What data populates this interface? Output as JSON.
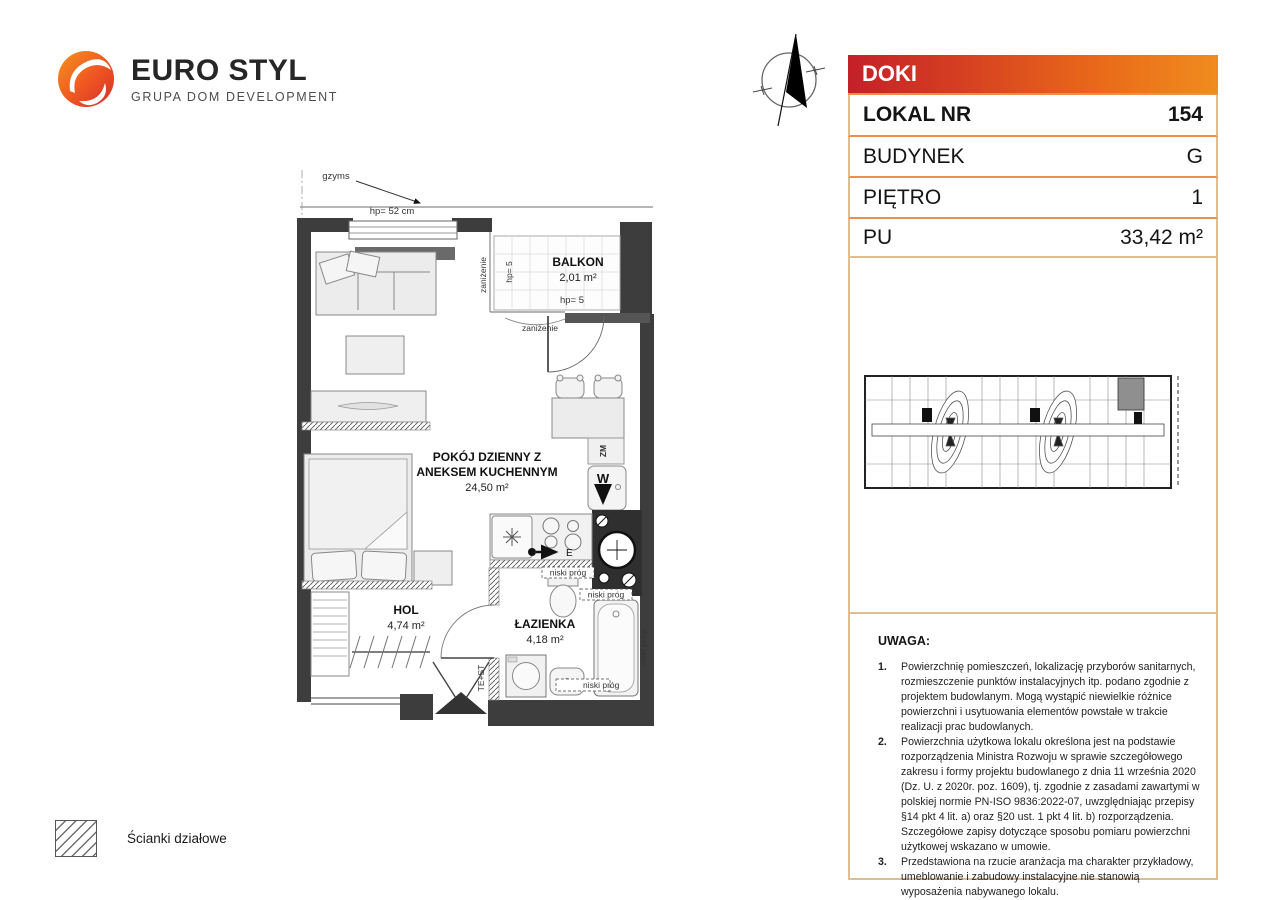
{
  "brand": {
    "name": "EURO STYL",
    "subtitle": "GRUPA DOM DEVELOPMENT"
  },
  "unit_card": {
    "project": "DOKI",
    "rows": [
      {
        "label": "LOKAL NR",
        "value": "154"
      },
      {
        "label": "BUDYNEK",
        "value": "G"
      },
      {
        "label": "PIĘTRO",
        "value": "1"
      },
      {
        "label": "PU",
        "value": "33,42 m²"
      }
    ]
  },
  "floorplan": {
    "labels": {
      "pokoj_line1": "POKÓJ DZIENNY Z",
      "pokoj_line2": "ANEKSEM KUCHENNYM",
      "pokoj_area": "24,50 m²",
      "hol": "HOL",
      "hol_area": "4,74 m²",
      "lazienka": "ŁAZIENKA",
      "lazienka_area": "4,18 m²",
      "balkon": "BALKON",
      "balkon_area": "2,01 m²",
      "gzyms": "gzyms",
      "hp_52": "hp= 52 cm",
      "hp_5": "hp= 5",
      "zanizenie": "zaniżenie",
      "niski_prog": "niski próg",
      "te_st": "TE+ST",
      "zm": "ZM",
      "w": "W",
      "e": "E"
    }
  },
  "notes": {
    "title": "UWAGA:",
    "items": [
      {
        "num": "1.",
        "text": "Powierzchnię pomieszczeń, lokalizację przyborów sanitarnych, rozmieszczenie punktów instalacyjnych itp. podano zgodnie z projektem budowlanym. Mogą wystąpić niewielkie różnice powierzchni i usytuowania elementów powstałe w trakcie realizacji prac budowlanych."
      },
      {
        "num": "2.",
        "text": "Powierzchnia użytkowa lokalu określona jest na podstawie rozporządzenia Ministra Rozwoju w sprawie szczegółowego zakresu i formy projektu budowlanego z dnia 11 września 2020 (Dz. U. z 2020r. poz. 1609), tj. zgodnie z zasadami zawartymi w polskiej normie PN-ISO 9836:2022-07, uwzględniając przepisy §14 pkt 4 lit. a) oraz §20 ust. 1 pkt 4 lit. b) rozporządzenia. Szczegółowe zapisy dotyczące sposobu pomiaru powierzchni użytkowej wskazano w umowie."
      },
      {
        "num": "3.",
        "text": "Przedstawiona na rzucie aranżacja ma charakter przykładowy, umeblowanie i zabudowy instalacyjne nie stanowią wyposażenia nabywanego lokalu."
      }
    ]
  },
  "legend": {
    "partition_walls": "Ścianki działowe"
  },
  "colors": {
    "header_red": "#c32029",
    "header_orange": "#f08c1e",
    "separator_orange": "#ef8e44",
    "box_border_tan": "#dfbd92",
    "logo_red": "#e63a23",
    "logo_orange": "#f7941d",
    "wall_black": "#3d3d3d"
  }
}
